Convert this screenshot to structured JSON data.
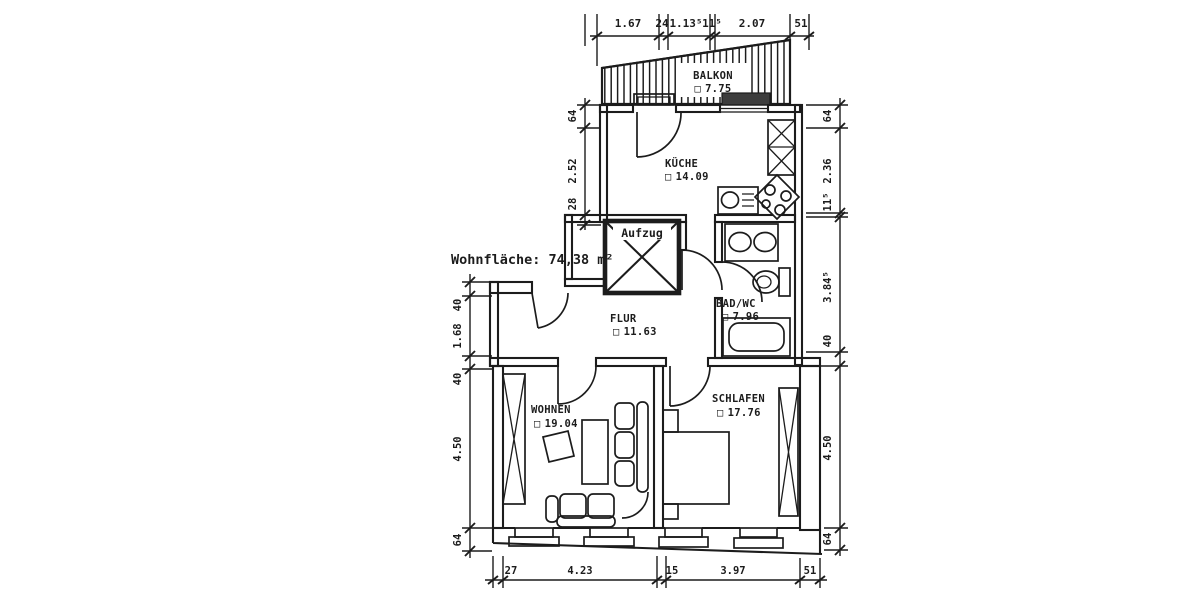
{
  "title": "Wohnfläche: 74,38 m²",
  "elevator_label": "Aufzug",
  "area_glyph": "□",
  "rooms": {
    "balkon": {
      "name": "BALKON",
      "area": "7.75"
    },
    "kueche": {
      "name": "KÜCHE",
      "area": "14.09"
    },
    "flur": {
      "name": "FLUR",
      "area": "11.63"
    },
    "bad": {
      "name": "BAD/WC",
      "area": "7.96"
    },
    "wohnen": {
      "name": "WOHNEN",
      "area": "19.04"
    },
    "schlafen": {
      "name": "SCHLAFEN",
      "area": "17.76"
    }
  },
  "dimensions": {
    "top": [
      "1.67",
      "24",
      "1.13⁵",
      "11⁵",
      "2.07",
      "51"
    ],
    "bottom": [
      "27",
      "4.23",
      "15",
      "3.97",
      "51"
    ],
    "left_upper": [
      "64",
      "2.52",
      "28"
    ],
    "left_lower": [
      "40",
      "1.68",
      "40",
      "4.50",
      "64"
    ],
    "right": [
      "64",
      "2.36",
      "11⁵",
      "3.84⁵",
      "40",
      "4.50",
      "64"
    ]
  },
  "colors": {
    "ink": "#1c1c1c",
    "paper": "#ffffff"
  }
}
